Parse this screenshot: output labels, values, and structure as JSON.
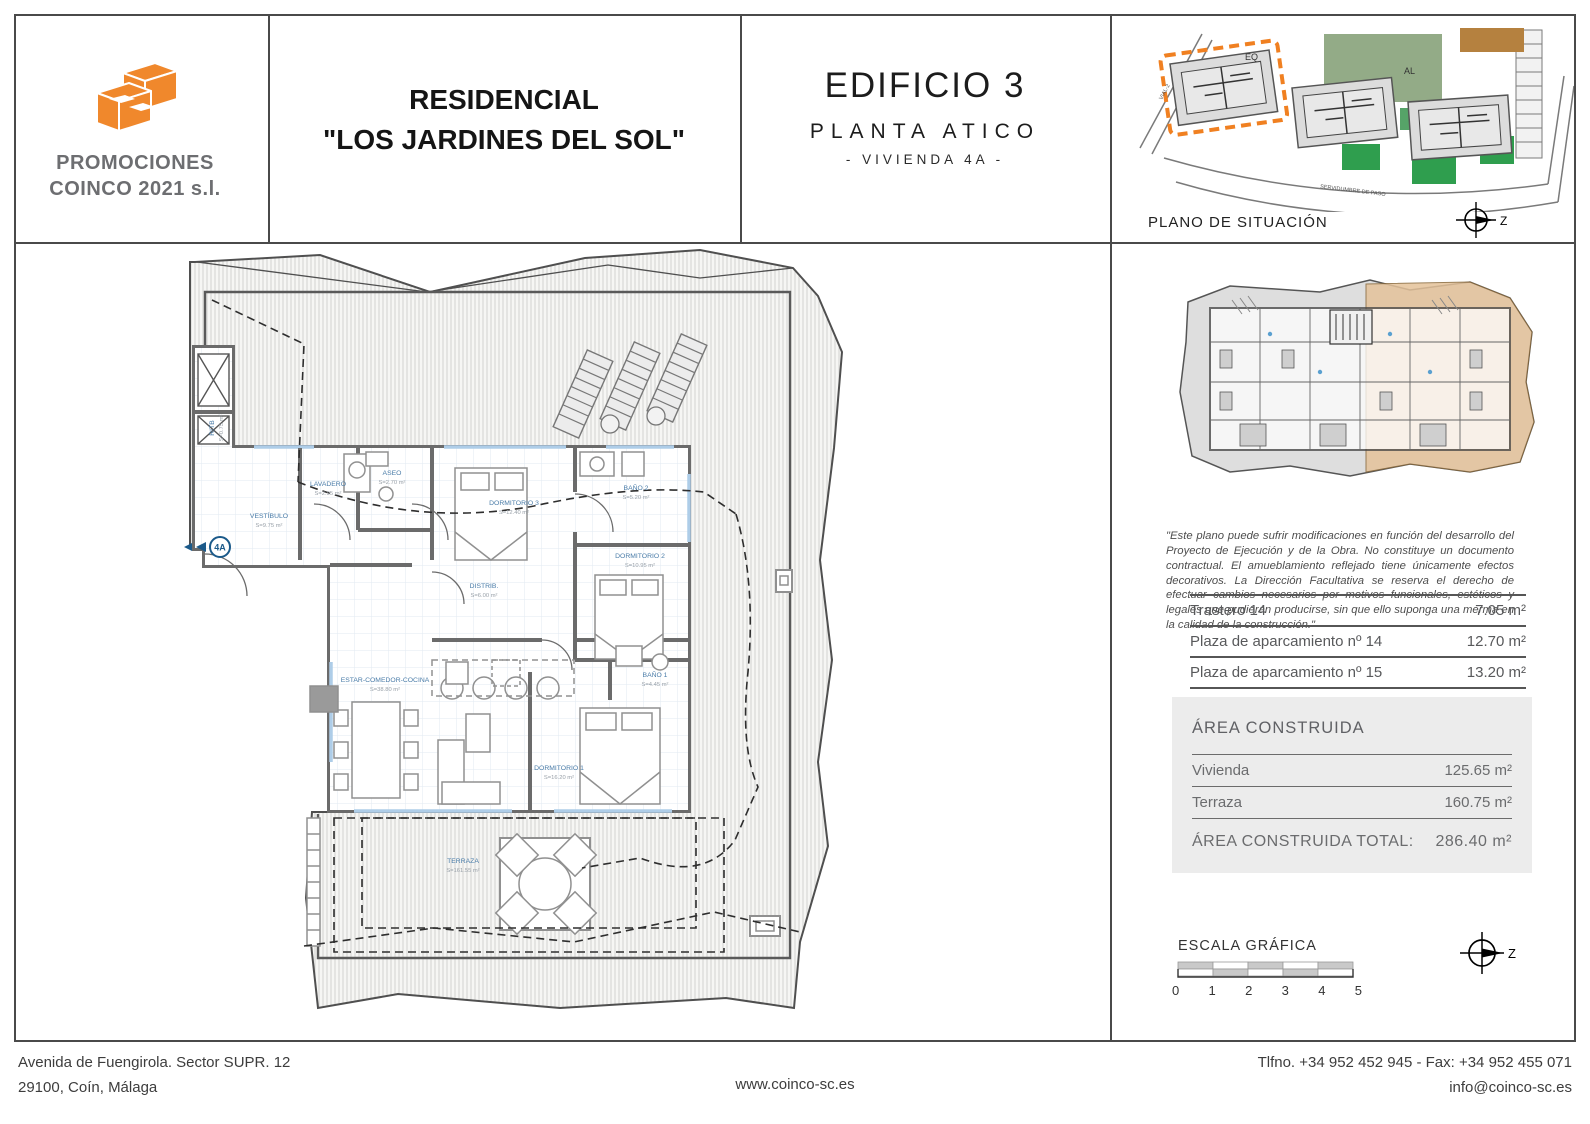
{
  "header": {
    "company": {
      "name_line1": "PROMOCIONES",
      "name_line2": "COINCO 2021 s.l."
    },
    "title_line1": "RESIDENCIAL",
    "title_line2": "\"LOS JARDINES DEL SOL\"",
    "building": "EDIFICIO 3",
    "floor": "PLANTA ATICO",
    "unit": "- VIVIENDA  4A -",
    "situation_caption": "PLANO DE SITUACIÓN",
    "situation_labels": {
      "eq": "EQ",
      "al": "AL",
      "vial": "VIAL-2",
      "street": "SERVIDUMBRE DE PASO"
    },
    "compass_label": "Z"
  },
  "floor_plan": {
    "entrance_label": "4A",
    "rooms": [
      {
        "name": "VESTÍBULO",
        "area": "S=9.75 m²"
      },
      {
        "name": "LAVADERO",
        "area": "S=2.95 m²"
      },
      {
        "name": "ASEO",
        "area": "S=2.70 m²"
      },
      {
        "name": "RITB",
        "area": "S=0.75 m²"
      },
      {
        "name": "DORMITORIO 3",
        "area": "S=12.40 m²"
      },
      {
        "name": "BAÑO 2",
        "area": "S=5.20 m²"
      },
      {
        "name": "DORMITORIO 2",
        "area": "S=10.95 m²"
      },
      {
        "name": "DISTRIB.",
        "area": "S=6.00 m²"
      },
      {
        "name": "ESTAR-COMEDOR-COCINA",
        "area": "S=38.80 m²"
      },
      {
        "name": "BAÑO 1",
        "area": "S=4.45 m²"
      },
      {
        "name": "DORMITORIO 1",
        "area": "S=16.20 m²"
      },
      {
        "name": "TERRAZA",
        "area": "S=161.55 m²"
      }
    ]
  },
  "sidebar": {
    "disclaimer": "\"Este plano puede sufrir modificaciones en función del desarrollo del Proyecto de Ejecución y de la Obra. No constituye un documento contractual. El amueblamiento reflejado tiene únicamente efectos decorativos. La Dirección Facultativa se reserva el derecho de efectuar cambios necesarios por motivos funcionales, estéticos y legales que pudieran producirse, sin que ello suponga una merma en la calidad de la construcción.\"",
    "annex_table": [
      {
        "label": "Trastero 14",
        "value": "7.05 m²"
      },
      {
        "label": "Plaza de aparcamiento  nº 14",
        "value": "12.70 m²"
      },
      {
        "label": "Plaza de aparcamiento  nº 15",
        "value": "13.20 m²"
      }
    ],
    "area_box": {
      "title": "ÁREA CONSTRUIDA",
      "rows": [
        {
          "label": "Vivienda",
          "value": "125.65 m²"
        },
        {
          "label": "Terraza",
          "value": "160.75 m²"
        }
      ],
      "total_label": "ÁREA CONSTRUIDA TOTAL:",
      "total_value": "286.40 m²"
    },
    "scale": {
      "title": "ESCALA GRÁFICA",
      "ticks": [
        "0",
        "1",
        "2",
        "3",
        "4",
        "5"
      ]
    },
    "compass_label": "Z"
  },
  "footer": {
    "address_line1": "Avenida de Fuengirola. Sector SUPR. 12",
    "address_line2": "29100, Coín, Málaga",
    "website": "www.coinco-sc.es",
    "phone": "Tlfno. +34 952 452 945 - Fax: +34 952 455 071",
    "email": "info@coinco-sc.es"
  },
  "colors": {
    "accent_orange": "#f0882c",
    "label_blue": "#4a7ca8",
    "text_gray": "#58595b"
  }
}
